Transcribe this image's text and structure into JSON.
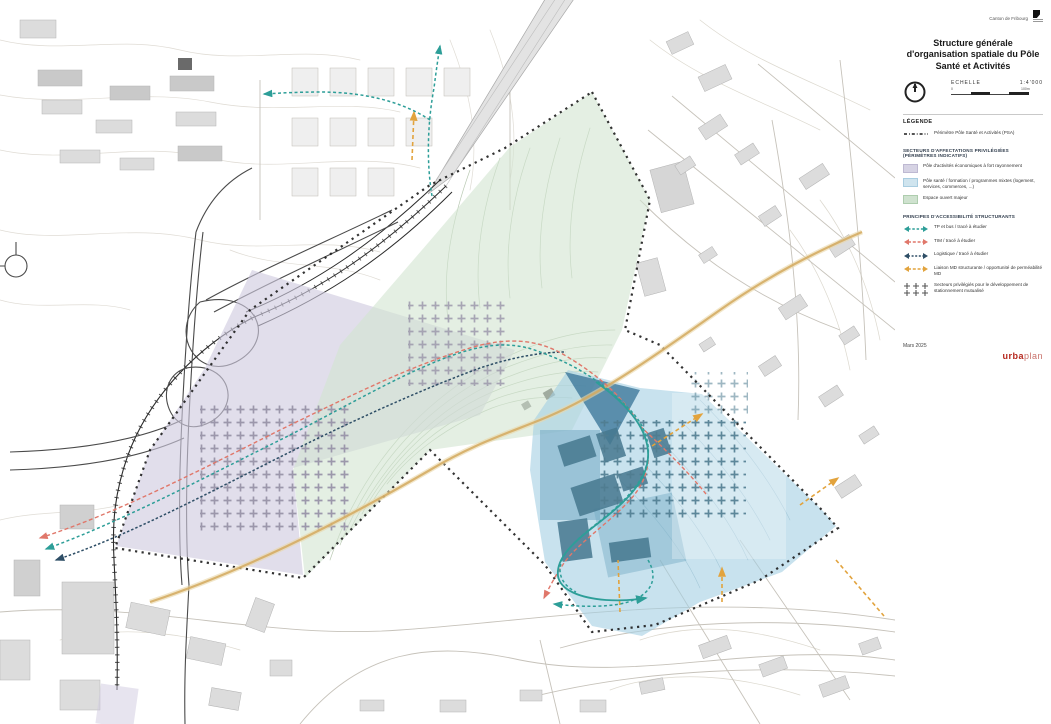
{
  "panel": {
    "canton": "Canton de Fribourg",
    "title": "Structure générale d'organisation spatiale du Pôle Santé et Activités",
    "scale_label": "ECHELLE",
    "scale_value": "1:4'000",
    "scale_zero": "0",
    "scale_end": "100m",
    "legend_title": "LÉGENDE",
    "date": "Mars 2025",
    "logo_bold": "urba",
    "logo_light": "plan"
  },
  "legend": {
    "perimeter_label": "Périmètre Pôle Santé et Activités (PSA)",
    "sectors_header": "SECTEURS D'AFFECTATIONS PRIVILÉGIÉES (PÉRIMÈTRES INDICATIFS)",
    "sectors": [
      {
        "label": "Pôle d'activités économiques à fort rayonnement",
        "css": "background:#d6d3e4;border:0.5px solid #beb9d2;"
      },
      {
        "label": "Pôle santé / formation / programmes mixtes (logement, services, commerces, ...)",
        "css": "background:#cfe4ee;border:0.5px solid #a9cde0;"
      },
      {
        "label": "Espace ouvert majeur",
        "css": "background:#cfe2cf;border:0.5px solid #aecdae;"
      }
    ],
    "principles_header": "PRINCIPES D'ACCESSIBILITÉ STRUCTURANTS",
    "principles": [
      {
        "label": "TP et bus / tracé à étudier",
        "key": "tp"
      },
      {
        "label": "TIM / tracé à étudier",
        "key": "tim"
      },
      {
        "label": "Logistique / tracé à étudier",
        "key": "log"
      },
      {
        "label": "Liaison MD structurante / opportunité de perméabilité MD",
        "key": "md"
      }
    ],
    "parking_label": "Secteurs privilégiés pour le développement de stationnement mutualisé"
  },
  "colors": {
    "purple": "#cfcadf",
    "blue": "#a3cfe3",
    "green": "#d2e4d0",
    "tp": "#2d9e98",
    "tim": "#e0776a",
    "log": "#2e4e66",
    "md": "#e2a33d",
    "perimeter": "#1c1c1c",
    "brand": "#b5271d"
  }
}
